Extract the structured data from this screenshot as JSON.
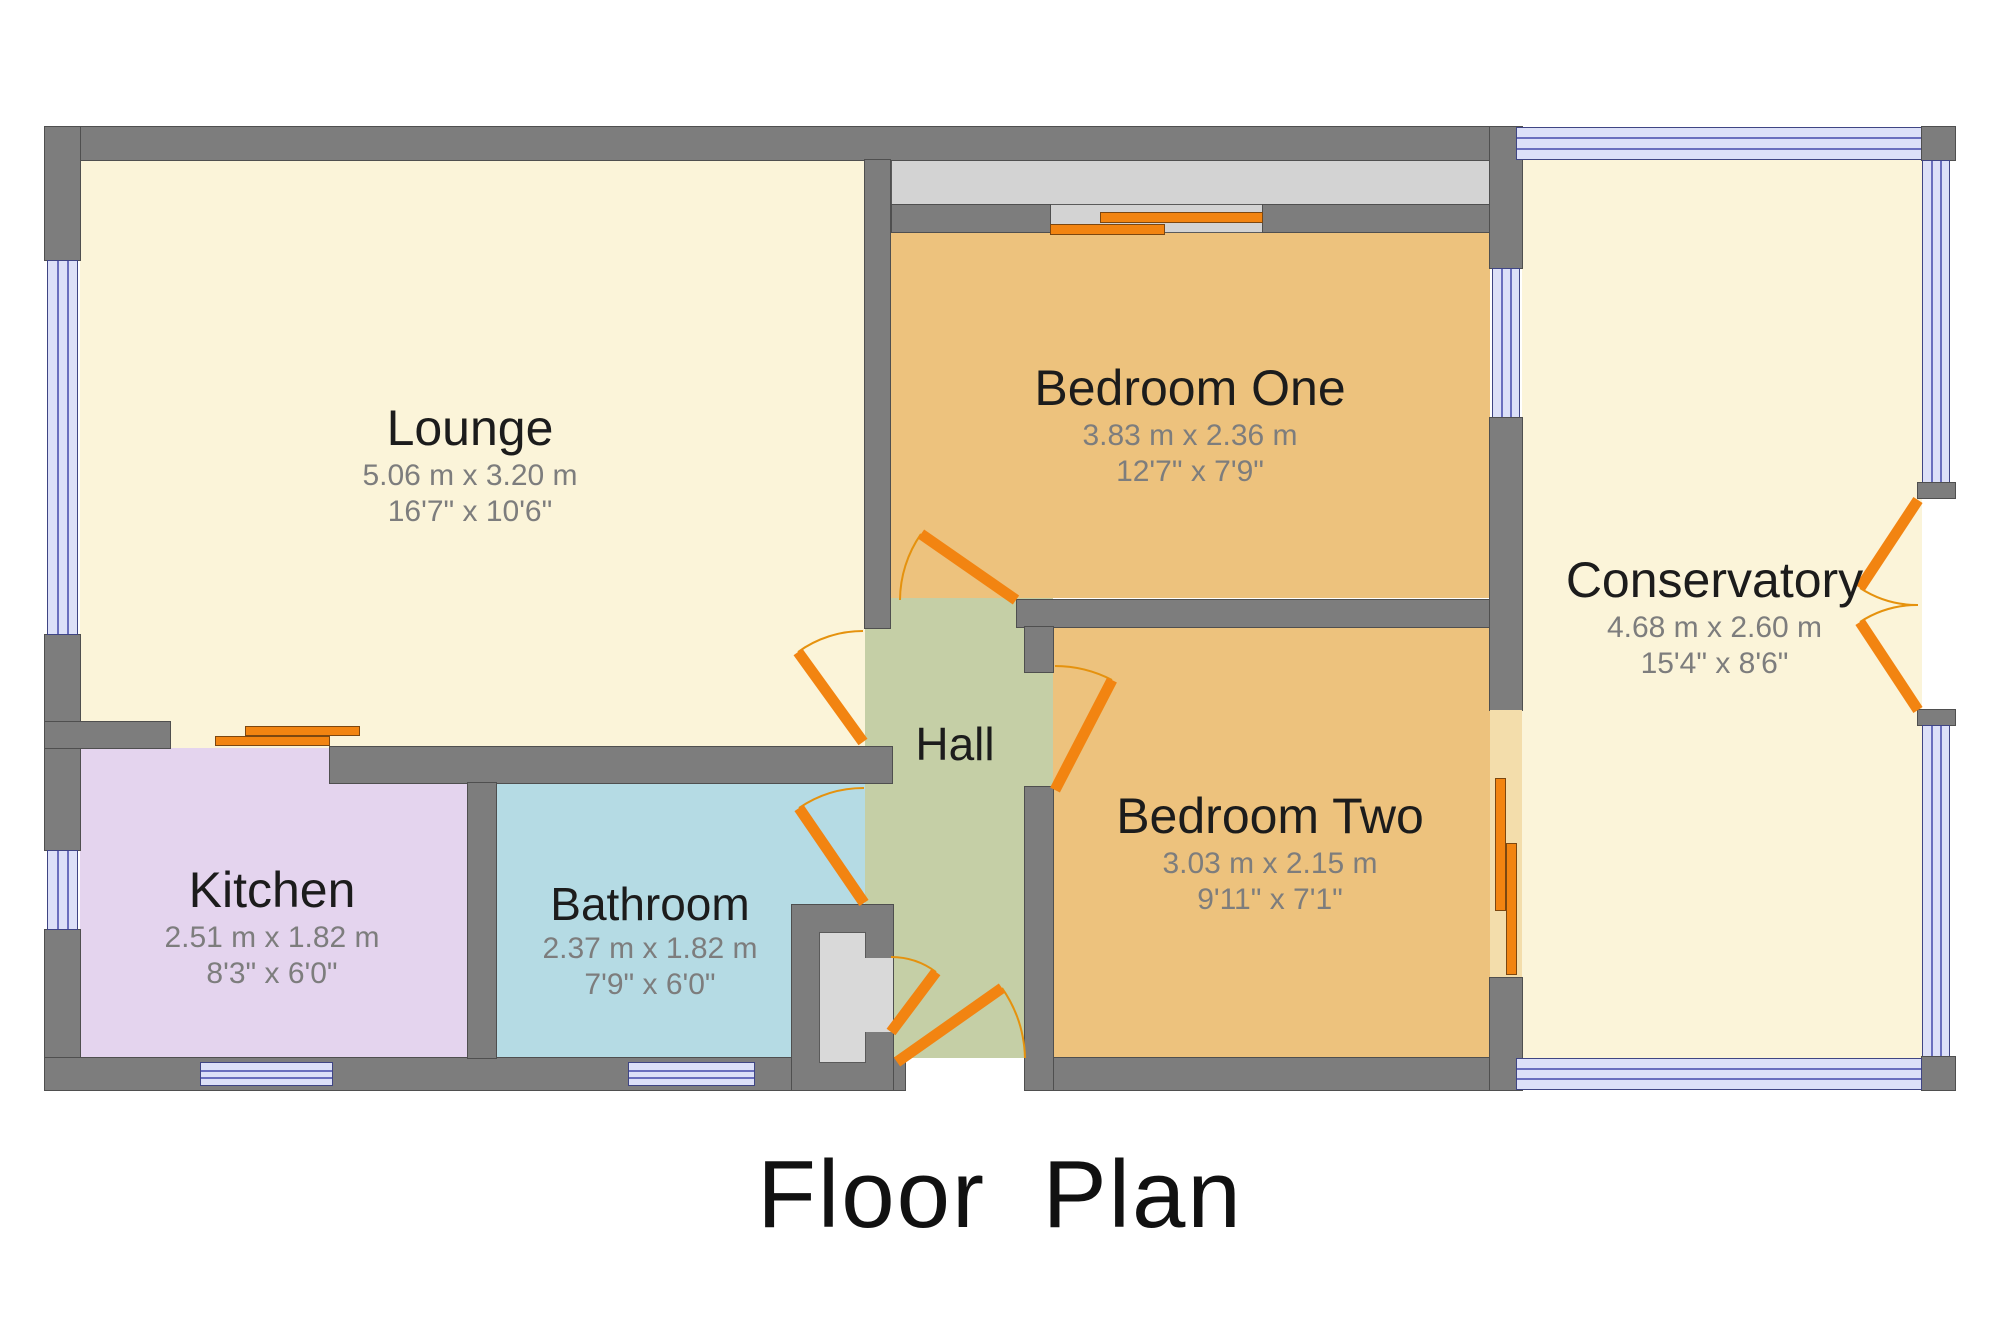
{
  "title": "Floor Plan",
  "rooms": [
    {
      "id": "lounge",
      "name": "Lounge",
      "metric": "5.06 m x 3.20 m",
      "imperial": "16'7\" x 10'6\""
    },
    {
      "id": "kitchen",
      "name": "Kitchen",
      "metric": "2.51 m x 1.82 m",
      "imperial": "8'3\" x 6'0\""
    },
    {
      "id": "bathroom",
      "name": "Bathroom",
      "metric": "2.37 m x 1.82 m",
      "imperial": "7'9\" x 6'0\""
    },
    {
      "id": "hall",
      "name": "Hall",
      "metric": "",
      "imperial": ""
    },
    {
      "id": "bedroom-one",
      "name": "Bedroom One",
      "metric": "3.83 m x 2.36 m",
      "imperial": "12'7\" x 7'9\""
    },
    {
      "id": "bedroom-two",
      "name": "Bedroom Two",
      "metric": "3.03 m x 2.15 m",
      "imperial": "9'11\" x 7'1\""
    },
    {
      "id": "conservatory",
      "name": "Conservatory",
      "metric": "4.68 m x 2.60 m",
      "imperial": "15'4\" x 8'6\""
    }
  ],
  "colors": {
    "background": "#ffffff",
    "wall": "#7d7d7d",
    "lounge": "#fbf4d9",
    "conservatory": "#fbf4d9",
    "kitchen": "#e4d4ee",
    "bathroom": "#b5dbe4",
    "hall": "#c5cfa6",
    "bedroom": "#edc27d",
    "bedroom_doorway": "#f3ddab",
    "wardrobe": "#d3d3d3",
    "cupboard": "#d9d9d9",
    "window_fill": "#dce0f8",
    "window_line": "#6a6fbe",
    "door": "#f28411",
    "text_dark": "#1c1c1c",
    "text_dim": "#7d7d7d"
  }
}
